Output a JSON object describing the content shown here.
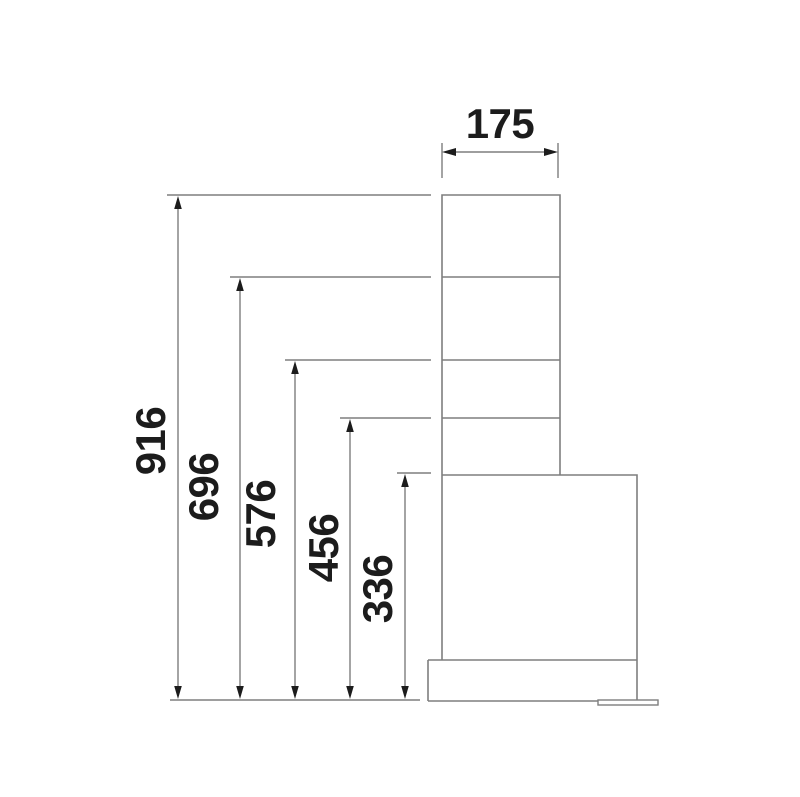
{
  "diagram": {
    "width_dimension": {
      "label": "175"
    },
    "height_dimensions": [
      {
        "label": "916"
      },
      {
        "label": "696"
      },
      {
        "label": "576"
      },
      {
        "label": "456"
      },
      {
        "label": "336"
      }
    ],
    "colors": {
      "line": "#7e7e7e",
      "text": "#1c1c1c",
      "background": "#ffffff"
    }
  }
}
